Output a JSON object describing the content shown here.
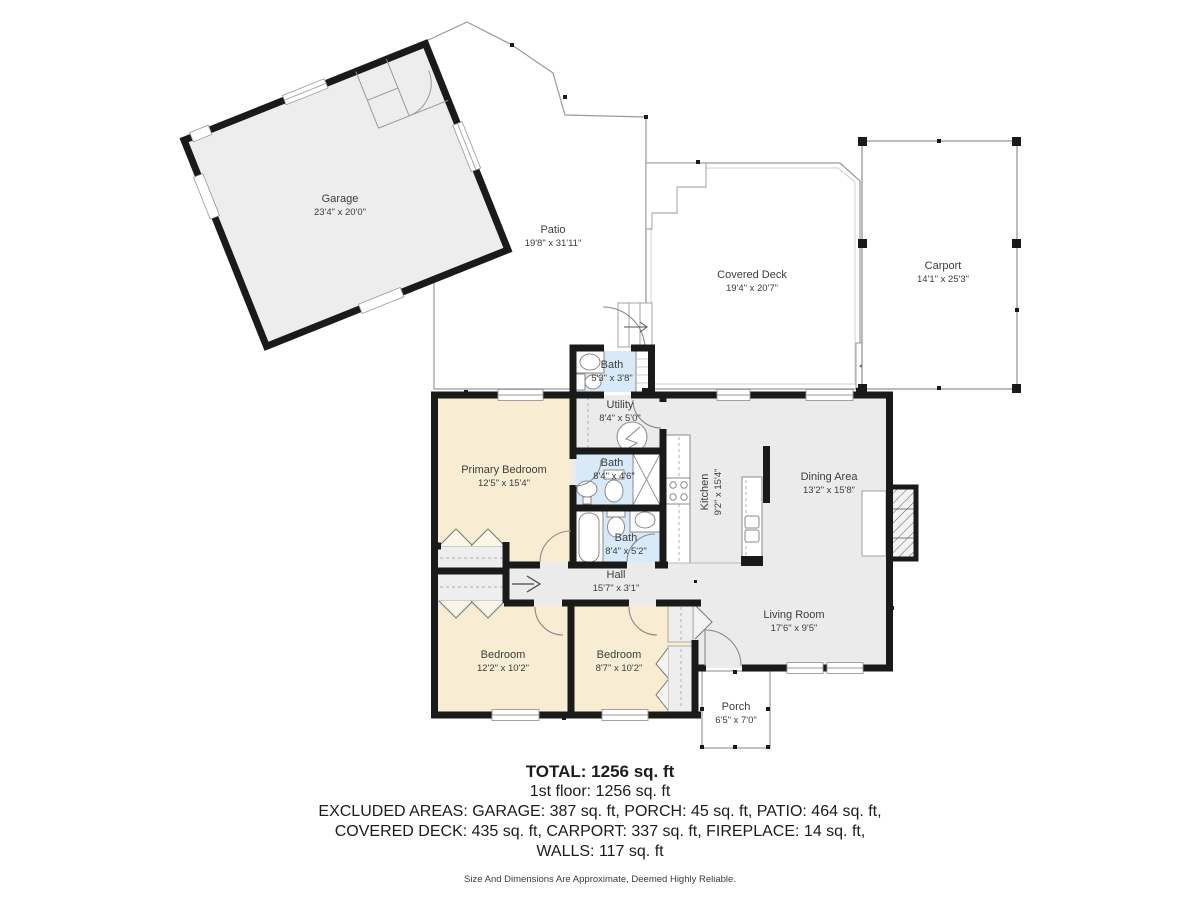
{
  "plan": {
    "rooms": {
      "garage": {
        "name": "Garage",
        "dims": "23'4\" x 20'0\""
      },
      "patio": {
        "name": "Patio",
        "dims": "19'8\" x 31'11\""
      },
      "covered_deck": {
        "name": "Covered Deck",
        "dims": "19'4\" x 20'7\""
      },
      "carport": {
        "name": "Carport",
        "dims": "14'1\" x 25'3\""
      },
      "bath_top": {
        "name": "Bath",
        "dims": "5'3\" x 3'8\""
      },
      "utility": {
        "name": "Utility",
        "dims": "8'4\" x 5'0\""
      },
      "bath_mid": {
        "name": "Bath",
        "dims": "8'4\" x 4'6\""
      },
      "bath_lower": {
        "name": "Bath",
        "dims": "8'4\" x 5'2\""
      },
      "kitchen": {
        "name": "Kitchen",
        "dims": "9'2\" x 15'4\""
      },
      "dining": {
        "name": "Dining Area",
        "dims": "13'2\" x 15'8\""
      },
      "primary_bedroom": {
        "name": "Primary Bedroom",
        "dims": "12'5\" x 15'4\""
      },
      "hall": {
        "name": "Hall",
        "dims": "15'7\" x 3'1\""
      },
      "living_room": {
        "name": "Living Room",
        "dims": "17'6\" x 9'5\""
      },
      "bedroom_left": {
        "name": "Bedroom",
        "dims": "12'2\" x 10'2\""
      },
      "bedroom_right": {
        "name": "Bedroom",
        "dims": "8'7\" x 10'2\""
      },
      "porch": {
        "name": "Porch",
        "dims": "6'5\" x 7'0\""
      }
    },
    "colors": {
      "wall": "#1a1a1a",
      "floor_gray": "#ebebeb",
      "bedroom_beige": "#f8ecd2",
      "bath_blue": "#d8eaf7",
      "outline_gray": "#999999"
    }
  },
  "summary": {
    "total": "TOTAL: 1256 sq. ft",
    "floor1": "1st floor: 1256 sq. ft",
    "excluded_line1": "EXCLUDED AREAS: GARAGE: 387 sq. ft, PORCH: 45 sq. ft, PATIO: 464 sq. ft,",
    "excluded_line2": "COVERED DECK: 435 sq. ft, CARPORT: 337 sq. ft, FIREPLACE: 14 sq. ft,",
    "excluded_line3": "WALLS: 117 sq. ft",
    "disclaimer": "Size And Dimensions Are Approximate, Deemed Highly Reliable."
  }
}
